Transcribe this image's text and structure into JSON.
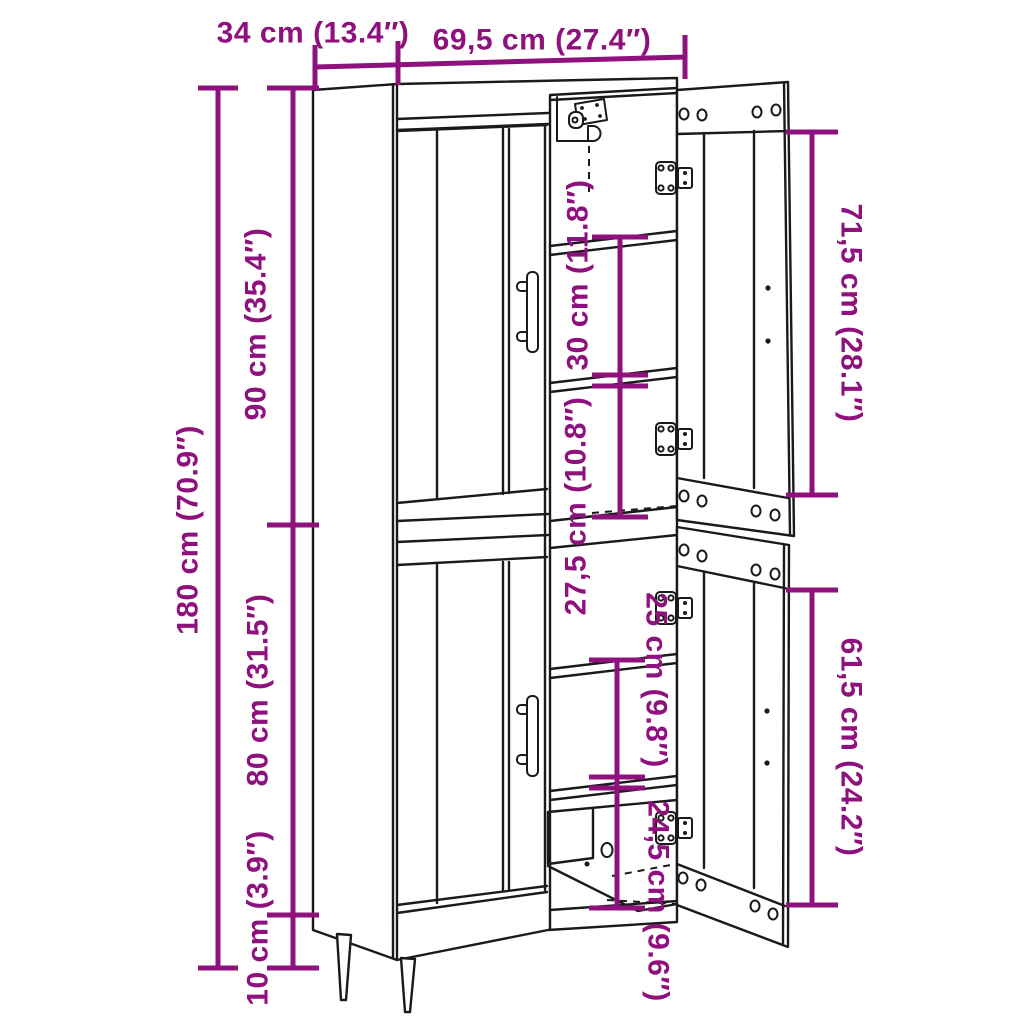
{
  "figure": {
    "kind": "furniture dimension line-art diagram",
    "subject": "tall 2-section highboard cabinet with open right doors, shelves, hinges and tapered legs"
  },
  "colors": {
    "dimension_accent": "#8F117D",
    "line_art": "#1a1a1a",
    "background": "#ffffff"
  },
  "dimensions": {
    "depth": {
      "label": "34 cm (13.4″)",
      "cm": 34,
      "inches": 13.4
    },
    "width": {
      "label": "69,5 cm (27.4″)",
      "cm": 69.5,
      "inches": 27.4
    },
    "total_height": {
      "label": "180 cm (70.9″)",
      "cm": 180,
      "inches": 70.9
    },
    "upper_section": {
      "label": "90 cm (35.4″)",
      "cm": 90,
      "inches": 35.4
    },
    "lower_section": {
      "label": "80 cm (31.5″)",
      "cm": 80,
      "inches": 31.5
    },
    "leg_height": {
      "label": "10 cm (3.9″)",
      "cm": 10,
      "inches": 3.9
    },
    "upper_shelf_gap": {
      "label": "30 cm (11.8″)",
      "cm": 30,
      "inches": 11.8
    },
    "upper_lower_gap": {
      "label": "27,5 cm (10.8″)",
      "cm": 27.5,
      "inches": 10.8
    },
    "lower_shelf_gap": {
      "label": "25 cm (9.8″)",
      "cm": 25,
      "inches": 9.8
    },
    "lower_bottom_gap": {
      "label": "24,5 cm (9.6″)",
      "cm": 24.5,
      "inches": 9.6
    },
    "upper_door": {
      "label": "71,5 cm (28.1″)",
      "cm": 71.5,
      "inches": 28.1
    },
    "lower_door": {
      "label": "61,5 cm (24.2″)",
      "cm": 61.5,
      "inches": 24.2
    }
  }
}
